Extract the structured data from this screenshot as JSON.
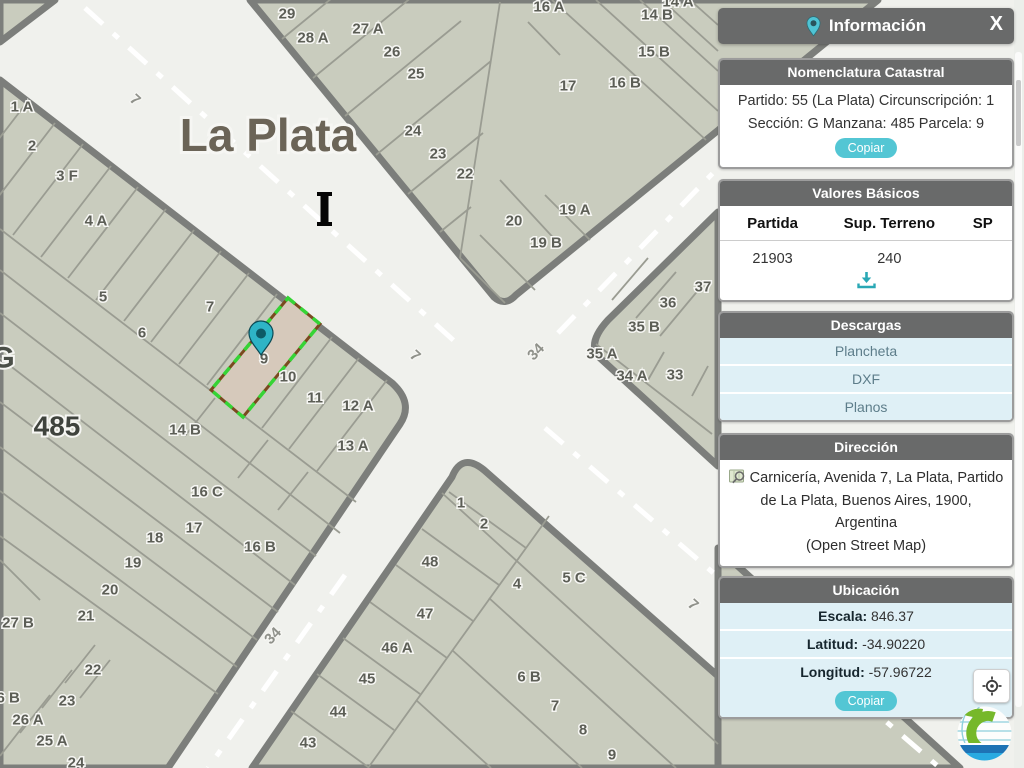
{
  "colors": {
    "accent_teal": "#53c6d4",
    "header_gray": "#696a6a",
    "row_blue": "#dff0f6",
    "map_block": "#c9ccbe",
    "map_road": "#f0f1ed",
    "selected_fill": "#d6c9bb",
    "selected_green": "#35d435"
  },
  "panel": {
    "title": "Información",
    "close_label": "X",
    "nomenclatura": {
      "title": "Nomenclatura Catastral",
      "line1": "Partido: 55 (La Plata) Circunscripción: 1",
      "line2": "Sección: G Manzana: 485 Parcela: 9",
      "copy_label": "Copiar"
    },
    "valores": {
      "title": "Valores Básicos",
      "headers": [
        "Partida",
        "Sup. Terreno",
        "SP"
      ],
      "values": [
        "21903",
        "240",
        ""
      ]
    },
    "descargas": {
      "title": "Descargas",
      "items": [
        "Plancheta",
        "DXF",
        "Planos"
      ]
    },
    "direccion": {
      "title": "Dirección",
      "line1": "Carnicería, Avenida 7, La Plata, Partido",
      "line2": "de La Plata, Buenos Aires, 1900, Argentina",
      "line3": "(Open Street Map)"
    },
    "ubicacion": {
      "title": "Ubicación",
      "rows": [
        {
          "label": "Escala:",
          "value": "846.37"
        },
        {
          "label": "Latitud:",
          "value": "-34.90220"
        },
        {
          "label": "Longitud:",
          "value": "-57.96722"
        }
      ],
      "copy_label": "Copiar"
    }
  },
  "map": {
    "city_label": "La Plata",
    "section_label": "G",
    "block_label": "485",
    "adjacent_block_label": "Mz 486",
    "selected_parcel_label": "9",
    "street_labels": [
      {
        "t": "7",
        "x": 135,
        "y": 100,
        "r": 42
      },
      {
        "t": "7",
        "x": 415,
        "y": 356,
        "r": 42
      },
      {
        "t": "7",
        "x": 693,
        "y": 605,
        "r": 42
      },
      {
        "t": "34",
        "x": 536,
        "y": 352,
        "r": -46
      },
      {
        "t": "34",
        "x": 273,
        "y": 636,
        "r": -46
      }
    ],
    "parcel_labels": [
      {
        "t": "29",
        "x": 287,
        "y": 14
      },
      {
        "t": "28 A",
        "x": 313,
        "y": 38
      },
      {
        "t": "27 A",
        "x": 368,
        "y": 29
      },
      {
        "t": "26",
        "x": 392,
        "y": 52
      },
      {
        "t": "25",
        "x": 416,
        "y": 74
      },
      {
        "t": "24",
        "x": 413,
        "y": 131
      },
      {
        "t": "23",
        "x": 438,
        "y": 154
      },
      {
        "t": "22",
        "x": 465,
        "y": 174
      },
      {
        "t": "20",
        "x": 514,
        "y": 221
      },
      {
        "t": "19 A",
        "x": 575,
        "y": 210
      },
      {
        "t": "19 B",
        "x": 546,
        "y": 243
      },
      {
        "t": "17",
        "x": 568,
        "y": 86
      },
      {
        "t": "16 A",
        "x": 549,
        "y": 7
      },
      {
        "t": "16 B",
        "x": 625,
        "y": 83
      },
      {
        "t": "15 B",
        "x": 654,
        "y": 52
      },
      {
        "t": "14 B",
        "x": 657,
        "y": 15
      },
      {
        "t": "14 A",
        "x": 678,
        "y": 2
      },
      {
        "t": "37",
        "x": 703,
        "y": 287
      },
      {
        "t": "36",
        "x": 668,
        "y": 303
      },
      {
        "t": "35 B",
        "x": 644,
        "y": 327
      },
      {
        "t": "35 A",
        "x": 602,
        "y": 354
      },
      {
        "t": "34 A",
        "x": 632,
        "y": 376
      },
      {
        "t": "33",
        "x": 675,
        "y": 375
      },
      {
        "t": "1 A",
        "x": 22,
        "y": 107
      },
      {
        "t": "2",
        "x": 32,
        "y": 146
      },
      {
        "t": "3 F",
        "x": 67,
        "y": 176
      },
      {
        "t": "4 A",
        "x": 96,
        "y": 221
      },
      {
        "t": "5",
        "x": 103,
        "y": 297
      },
      {
        "t": "6",
        "x": 142,
        "y": 333
      },
      {
        "t": "7",
        "x": 210,
        "y": 307
      },
      {
        "t": "9",
        "x": 264,
        "y": 359
      },
      {
        "t": "10",
        "x": 288,
        "y": 377
      },
      {
        "t": "11",
        "x": 315,
        "y": 398
      },
      {
        "t": "12 A",
        "x": 358,
        "y": 406
      },
      {
        "t": "13 A",
        "x": 353,
        "y": 446
      },
      {
        "t": "14 B",
        "x": 185,
        "y": 430
      },
      {
        "t": "16 C",
        "x": 207,
        "y": 492
      },
      {
        "t": "16 B",
        "x": 260,
        "y": 547
      },
      {
        "t": "17",
        "x": 194,
        "y": 528
      },
      {
        "t": "18",
        "x": 155,
        "y": 538
      },
      {
        "t": "19",
        "x": 133,
        "y": 563
      },
      {
        "t": "20",
        "x": 110,
        "y": 590
      },
      {
        "t": "21",
        "x": 86,
        "y": 616
      },
      {
        "t": "27 B",
        "x": 18,
        "y": 623
      },
      {
        "t": "22",
        "x": 93,
        "y": 670
      },
      {
        "t": "23",
        "x": 67,
        "y": 701
      },
      {
        "t": "26 A",
        "x": 28,
        "y": 720
      },
      {
        "t": "25 A",
        "x": 52,
        "y": 741
      },
      {
        "t": "24",
        "x": 76,
        "y": 763
      },
      {
        "t": "26 B",
        "x": 4,
        "y": 698
      },
      {
        "t": "1",
        "x": 461,
        "y": 503
      },
      {
        "t": "2",
        "x": 484,
        "y": 524
      },
      {
        "t": "48",
        "x": 430,
        "y": 562
      },
      {
        "t": "4",
        "x": 517,
        "y": 584
      },
      {
        "t": "5 C",
        "x": 574,
        "y": 578
      },
      {
        "t": "47",
        "x": 425,
        "y": 614
      },
      {
        "t": "46 A",
        "x": 397,
        "y": 648
      },
      {
        "t": "45",
        "x": 367,
        "y": 679
      },
      {
        "t": "44",
        "x": 338,
        "y": 712
      },
      {
        "t": "43",
        "x": 308,
        "y": 743
      },
      {
        "t": "6 B",
        "x": 529,
        "y": 677
      },
      {
        "t": "7",
        "x": 555,
        "y": 706
      },
      {
        "t": "8",
        "x": 583,
        "y": 730
      },
      {
        "t": "9",
        "x": 612,
        "y": 755
      }
    ]
  }
}
